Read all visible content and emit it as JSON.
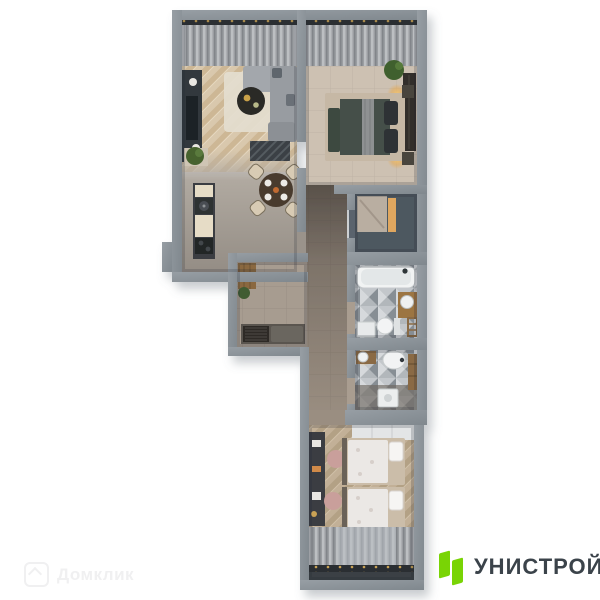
{
  "page": {
    "background_color": "#ffffff",
    "width": 600,
    "height": 600,
    "content": "3D top-down apartment floor plan render"
  },
  "branding": {
    "company_name": "УНИСТРОЙ",
    "text_color": "#3b434a",
    "mark_color": "#79d405",
    "mark_shape": "two-skewed-green-bars"
  },
  "watermark": {
    "text": "Домклик",
    "icon": "house-icon"
  },
  "floorplan": {
    "view": "top-down-3d-render",
    "palette": {
      "wall": "#8a9197",
      "wood_floor": "#d9c8ad",
      "kids_wood_floor": "#c2b097",
      "corridor_tile": "#7e746a",
      "hall_tile": "#a79c90",
      "bath_tile": "#b2b7bb",
      "accent_warm_light": "#f5c76e"
    },
    "rooms": [
      {
        "name": "living-room",
        "furniture": [
          "curtains",
          "tv-console",
          "sofa",
          "coffee-table",
          "rug",
          "plant",
          "partition-screen"
        ]
      },
      {
        "name": "kitchen-dining",
        "furniture": [
          "kitchen-counter",
          "sink",
          "stove",
          "dining-table",
          "four-dining-chairs"
        ]
      },
      {
        "name": "bedroom",
        "furniture": [
          "curtains",
          "double-bed",
          "bedside-lamps",
          "wardrobe",
          "bench",
          "plant"
        ]
      },
      {
        "name": "walk-in-closet",
        "furniture": [
          "illuminated-wardrobe"
        ]
      },
      {
        "name": "hallway",
        "furniture": [
          "wardrobe",
          "bench",
          "plant"
        ]
      },
      {
        "name": "bathroom-main",
        "furniture": [
          "bathtub",
          "vanity-sink",
          "toilet",
          "cabinet",
          "towel-ladder"
        ]
      },
      {
        "name": "bathroom-second",
        "furniture": [
          "vanity-sink",
          "toilet",
          "washing-machine",
          "towel-ladder"
        ]
      },
      {
        "name": "kids-room",
        "furniture": [
          "wardrobe",
          "desk",
          "two-chairs",
          "two-single-beds",
          "curtains"
        ]
      }
    ]
  }
}
